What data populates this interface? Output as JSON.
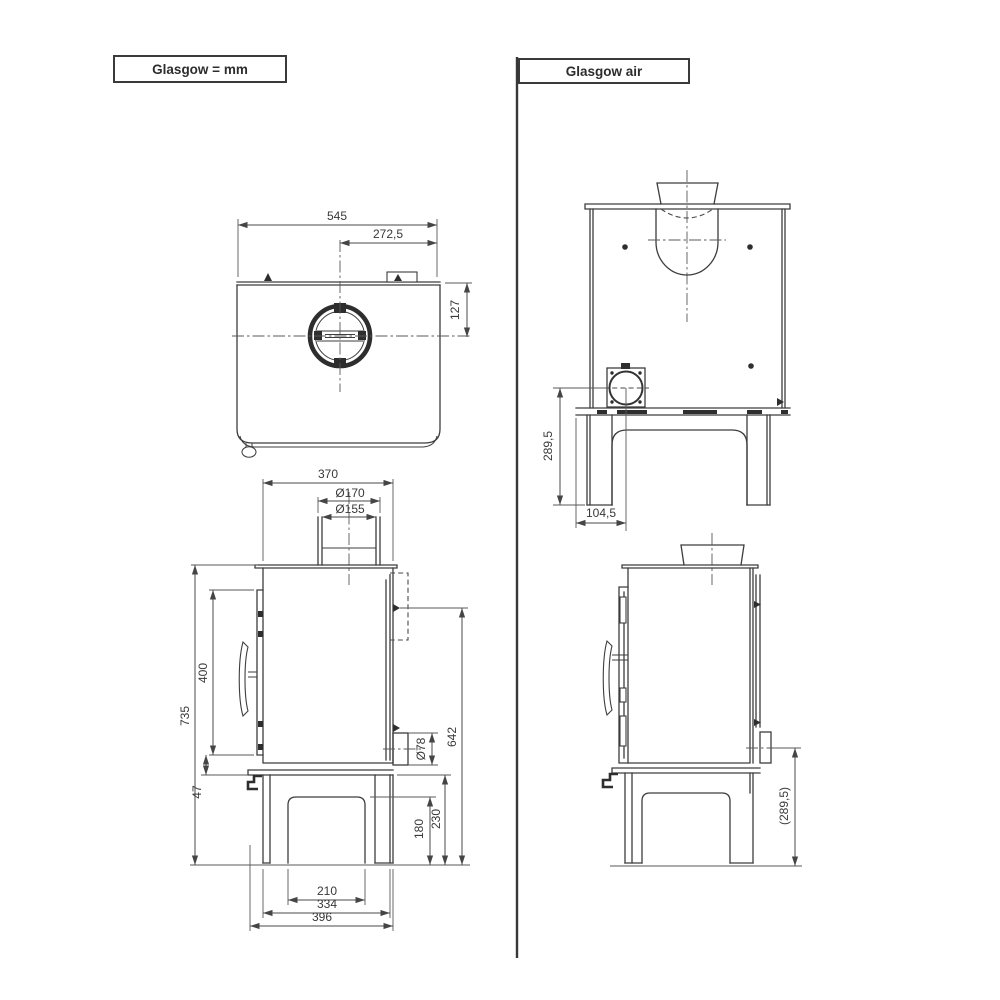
{
  "left_panel": {
    "title": "Glasgow = mm",
    "plan_view": {
      "overall_width": "545",
      "flue_center_from_right": "272,5",
      "flue_center_from_front_edge": "127"
    },
    "side_view": {
      "body_depth": "370",
      "flue_collar_outer": "Ø170",
      "flue_collar_inner": "Ø155",
      "overall_height": "735",
      "door_height": "400",
      "door_to_base_gap": "47",
      "air_inlet_diameter": "Ø78",
      "air_inlet_top_height": "642",
      "base_height": "230",
      "base_opening_height": "180",
      "base_opening_width": "210",
      "base_inner_depth": "334",
      "base_outer_depth": "396"
    }
  },
  "right_panel": {
    "title": "Glasgow air",
    "rear_view": {
      "air_inlet_center_height": "289,5",
      "air_inlet_center_offset": "104,5"
    },
    "side_view": {
      "air_inlet_center_height_ref": "(289,5)"
    }
  },
  "colors": {
    "line": "#3d3d3d",
    "background": "#ffffff"
  }
}
